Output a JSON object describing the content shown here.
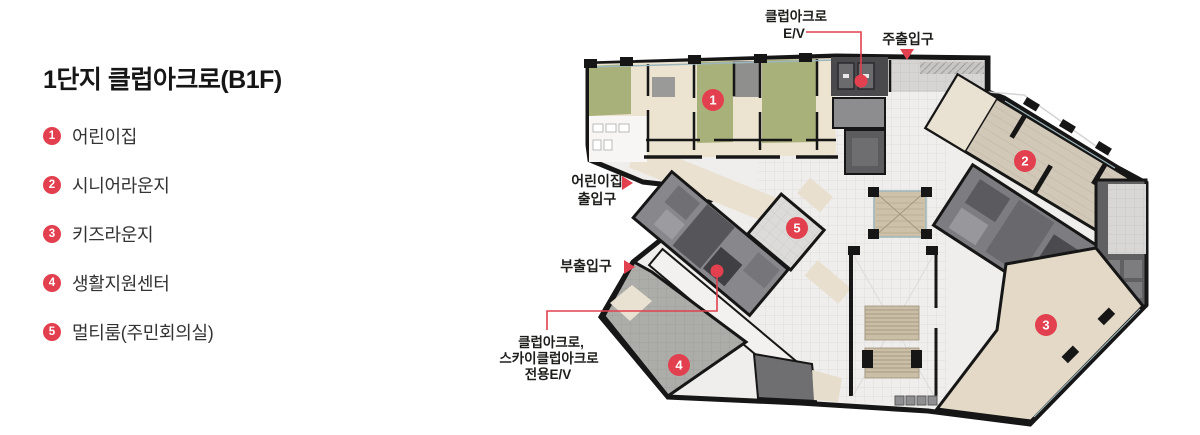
{
  "legend": {
    "title": "1단지 클럽아크로(B1F)",
    "items": [
      {
        "num": "1",
        "label": "어린이집"
      },
      {
        "num": "2",
        "label": "시니어라운지"
      },
      {
        "num": "3",
        "label": "키즈라운지"
      },
      {
        "num": "4",
        "label": "생활지원센터"
      },
      {
        "num": "5",
        "label": "멀티룸(주민회의실)"
      }
    ]
  },
  "plan": {
    "badges": [
      "1",
      "2",
      "3",
      "4",
      "5"
    ],
    "labels": {
      "ev_top_1": "클럽아크로",
      "ev_top_2": "E/V",
      "main_entrance": "주출입구",
      "daycare_1": "어린이집",
      "daycare_2": "출입구",
      "sub_entrance": "부출입구",
      "ev_bottom_1": "클럽아크로,",
      "ev_bottom_2": "스카이클럽아크로",
      "ev_bottom_3": "전용E/V"
    }
  },
  "colors": {
    "accent": "#e2404e",
    "olive_room": "#a9b17b",
    "room_beige": "#ece3d1",
    "wood_beige": "#d2c8b8",
    "area3_beige": "#e3d9c6",
    "wall": "#161616"
  }
}
